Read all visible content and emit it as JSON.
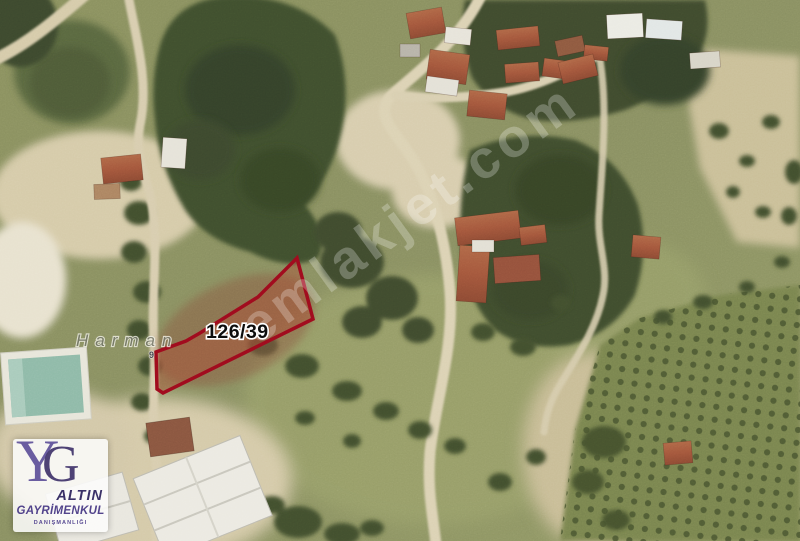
{
  "map": {
    "parcel": {
      "label": "126/39",
      "outline_color": "#9e0b1d",
      "fill_color": "rgba(178,69,47,0.38)"
    },
    "place_label": "Harman",
    "minor_label": "9",
    "watermark": "emlakjet.com"
  },
  "logo": {
    "monogram_y": "Y",
    "monogram_g": "G",
    "company": "ALTIN",
    "business": "GAYRİMENKUL",
    "subtitle": "DANIŞMANLIĞI",
    "accent_color": "#52448c"
  }
}
